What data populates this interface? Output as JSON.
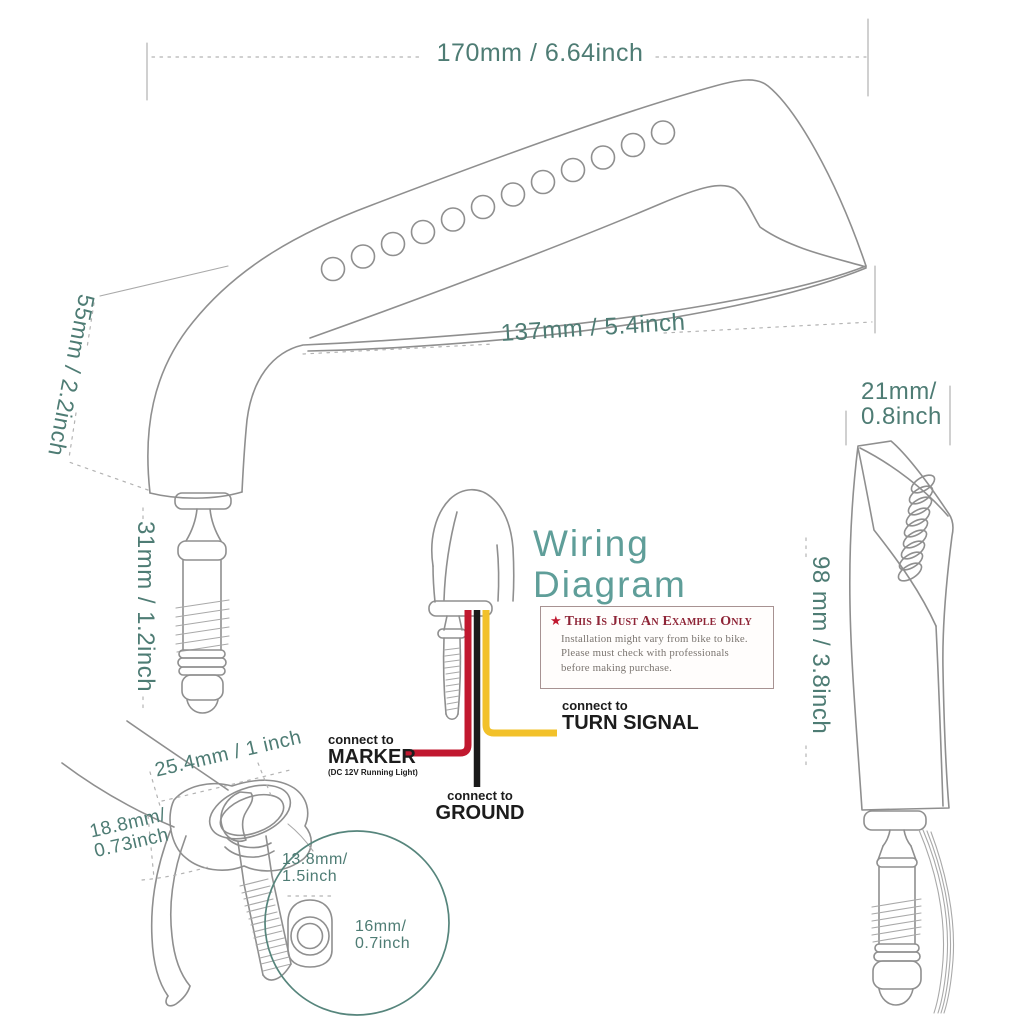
{
  "colors": {
    "dim_text": "#4e7c74",
    "title_teal": "#5f9e99",
    "note_title_red": "#8e2436",
    "star_red": "#c0182f",
    "note_body_gray": "#7b7570",
    "wire_red": "#c1182f",
    "wire_yellow": "#f2c12a",
    "wire_black": "#1a1a1a",
    "label_black": "#1c1c1c",
    "line_gray": "#8f8f8f",
    "detail_teal": "#56857c"
  },
  "front_view": {
    "dim_width": "170mm / 6.64inch",
    "dim_stem_height": "55mm / 2.2inch",
    "dim_mirror_face": "137mm / 5.4inch",
    "dim_bolt_length": "31mm / 1.2inch"
  },
  "side_view": {
    "dim_depth_line1": "21mm/",
    "dim_depth_line2": "0.8inch",
    "dim_height": "98 mm / 3.8inch"
  },
  "mount_detail": {
    "dim_base_width": "25.4mm / 1 inch",
    "dim_base_height_line1": "18.8mm/",
    "dim_base_height_line2": "0.73inch",
    "dim_hole_line1": "13.8mm/",
    "dim_hole_line2": "1.5inch",
    "dim_bolt_line1": "16mm/",
    "dim_bolt_line2": "0.7inch"
  },
  "wiring": {
    "title_line1": "Wiring",
    "title_line2": "Diagram",
    "note": {
      "star": "★",
      "title": "This Is Just An Example Only",
      "body_line1": "Installation might vary from bike to bike.",
      "body_line2": "Please must check with professionals",
      "body_line3": "before making purchase."
    },
    "marker": {
      "prefix": "connect to",
      "label": "MARKER",
      "sub": "(DC 12V Running Light)"
    },
    "turn_signal": {
      "prefix": "connect to",
      "label": "TURN SIGNAL"
    },
    "ground": {
      "prefix": "connect to",
      "label": "GROUND"
    }
  }
}
